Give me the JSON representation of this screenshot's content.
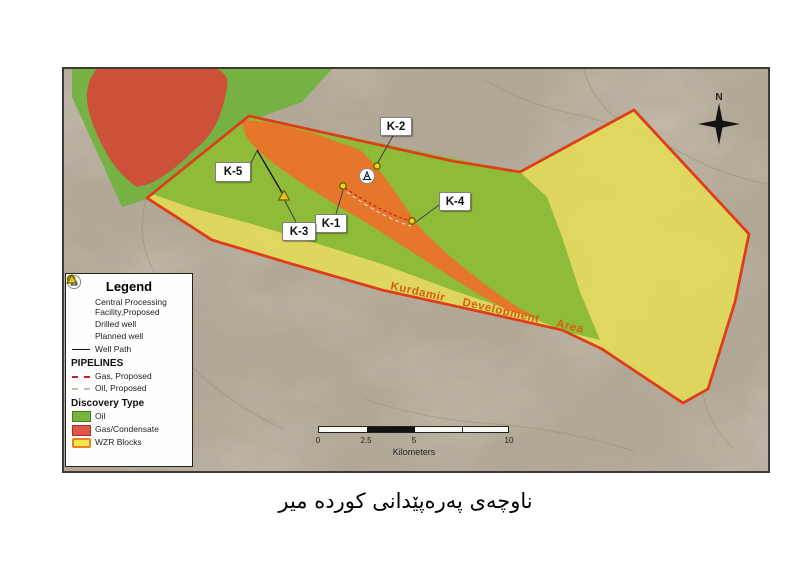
{
  "caption": "ناوچەی پەرەپێدانی کوردە میر",
  "map": {
    "area_label": "Kurdamir   Development   Area",
    "compass": "N",
    "wells": [
      {
        "label": "K-1",
        "type": "drilled"
      },
      {
        "label": "K-2",
        "type": "drilled"
      },
      {
        "label": "K-3",
        "type": "planned"
      },
      {
        "label": "K-4",
        "type": "drilled"
      },
      {
        "label": "K-5",
        "type": "drilled"
      }
    ],
    "scale_bar": {
      "ticks": [
        "0",
        "2.5",
        "5",
        "10"
      ],
      "unit": "Kilometers"
    }
  },
  "legend": {
    "title": "Legend",
    "items": [
      {
        "icon": "cpf-icon",
        "label_line1": "Central Processing",
        "label_line2": "Facility,Proposed"
      },
      {
        "icon": "drilled-well-icon",
        "label": "Drilled well"
      },
      {
        "icon": "planned-well-icon",
        "label": "Planned well"
      },
      {
        "icon": "well-path-icon",
        "label": "Well Path"
      }
    ],
    "pipelines_header": "PIPELINES",
    "pipeline_items": [
      {
        "icon": "gas-pipeline-icon",
        "label": "Gas, Proposed"
      },
      {
        "icon": "oil-pipeline-icon",
        "label": "Oil, Proposed"
      }
    ],
    "discovery_header": "Discovery Type",
    "discovery_items": [
      {
        "icon": "oil-swatch",
        "label": "Oil"
      },
      {
        "icon": "gas-swatch",
        "label": "Gas/Condensate"
      },
      {
        "icon": "wzr-swatch",
        "label": "WZR Blocks"
      }
    ]
  },
  "colors": {
    "terrain": "#b3a896",
    "oil_green_outside": "#6fb23a",
    "oil_green_inside": "#8aba36",
    "gas_red": "#d94338",
    "gas_over_block_orange": "#e9732a",
    "block_yellow": "#e6df52",
    "block_border_red": "#e03c1a",
    "area_label_color": "#d95f10",
    "pipeline_gas_red": "#cf2318"
  }
}
